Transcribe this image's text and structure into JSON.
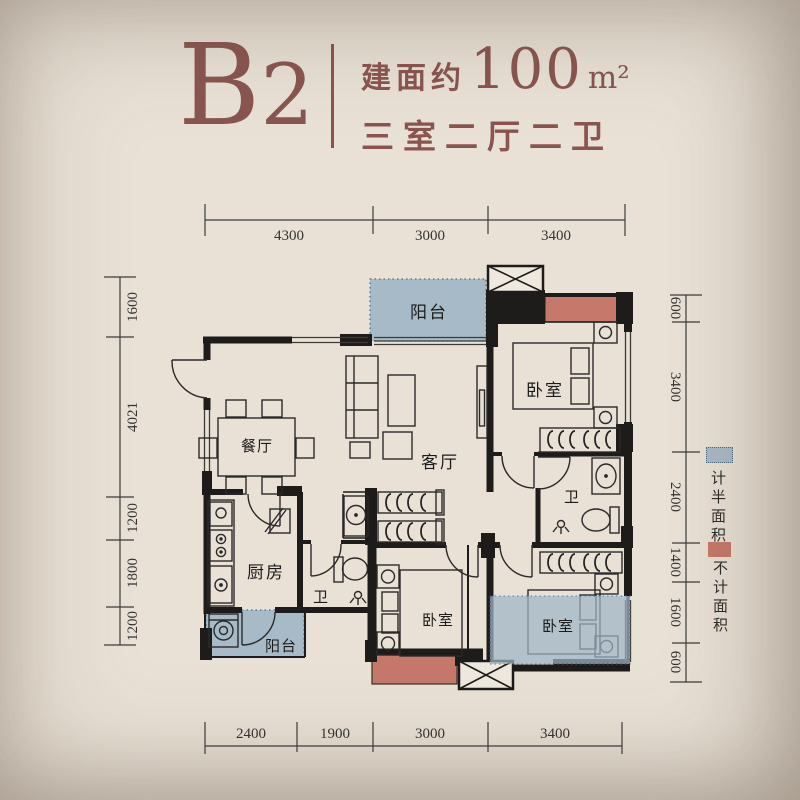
{
  "header": {
    "unit_code_b": "B",
    "unit_code_2": "2",
    "area_prefix": "建面约",
    "area_value": "100",
    "area_unit": "m²",
    "layout_desc": "三室二厅二卫"
  },
  "rooms": {
    "balcony": "阳台",
    "bedroom": "卧室",
    "dining": "餐厅",
    "living": "客厅",
    "kitchen": "厨房",
    "bath": "卫"
  },
  "legend": {
    "half_area": "计半面积",
    "excluded_area": "不计面积"
  },
  "dimensions": {
    "top": [
      "4300",
      "3000",
      "3400"
    ],
    "bottom": [
      "2400",
      "1900",
      "3000",
      "3400"
    ],
    "left": [
      "1600",
      "4021",
      "1200",
      "1800",
      "1200"
    ],
    "right": [
      "600",
      "3400",
      "2400",
      "1400",
      "1600",
      "600"
    ]
  },
  "colors": {
    "background": "#e9e1d6",
    "title_accent": "#8a5550",
    "wall": "#1e1c1a",
    "half_area_fill": "#a7bac7",
    "excluded_area_fill": "#c6796a"
  }
}
